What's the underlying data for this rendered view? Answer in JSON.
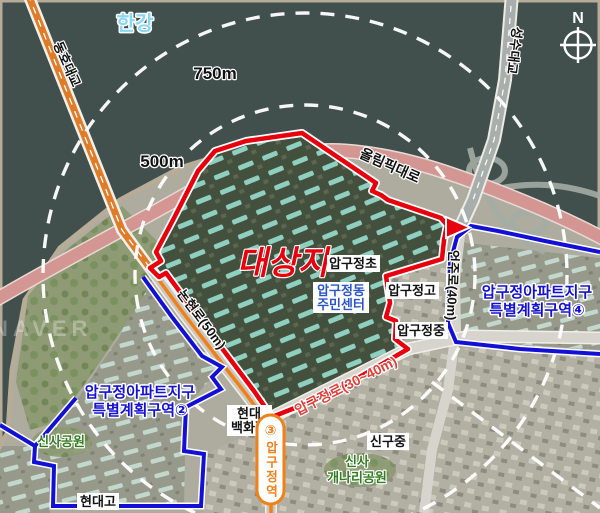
{
  "labels": {
    "river": "한강",
    "compass_n": "N",
    "radius_750": "750m",
    "radius_500": "500m",
    "bridge_dongho": "동호대교",
    "bridge_seongsu": "성수대교",
    "road_olympic": "올림픽대로",
    "road_nonhyeon": "논현로(50m)",
    "road_eonju": "언주로(40m)",
    "road_apgujeong": "압구정로(30~40m)",
    "site": "대상지",
    "school_elementary": "압구정초",
    "school_high": "압구정고",
    "school_middle": "압구정중",
    "school_hyundai": "현대고",
    "school_singu": "신구중",
    "community_center_line1": "압구정동",
    "community_center_line2": "주민센터",
    "district4_line1": "압구정아파트지구",
    "district4_line2": "특별계획구역④",
    "district2_line1": "압구정아파트지구",
    "district2_line2": "특별계획구역②",
    "dept_store_line1": "현대",
    "dept_store_line2": "백화점",
    "park_sinsa": "신사공원",
    "park_gaenari_line1": "신사",
    "park_gaenari_line2": "개나리공원",
    "station_line_badge": "③",
    "station_name": "압구정역",
    "watermark": "NAVER"
  },
  "colors": {
    "site_boundary": "#e8000c",
    "district_boundary": "#1310d6",
    "radius_circle": "#ffffff",
    "subway_line3": "#f08018",
    "water": "#41504d",
    "river_label": "#88d8f6",
    "park_label": "#2f7d1f",
    "community_label": "#2b55c8",
    "district_label": "#1310d6",
    "site_label": "#e8000c",
    "road_apgujeong_label": "#e04038"
  }
}
